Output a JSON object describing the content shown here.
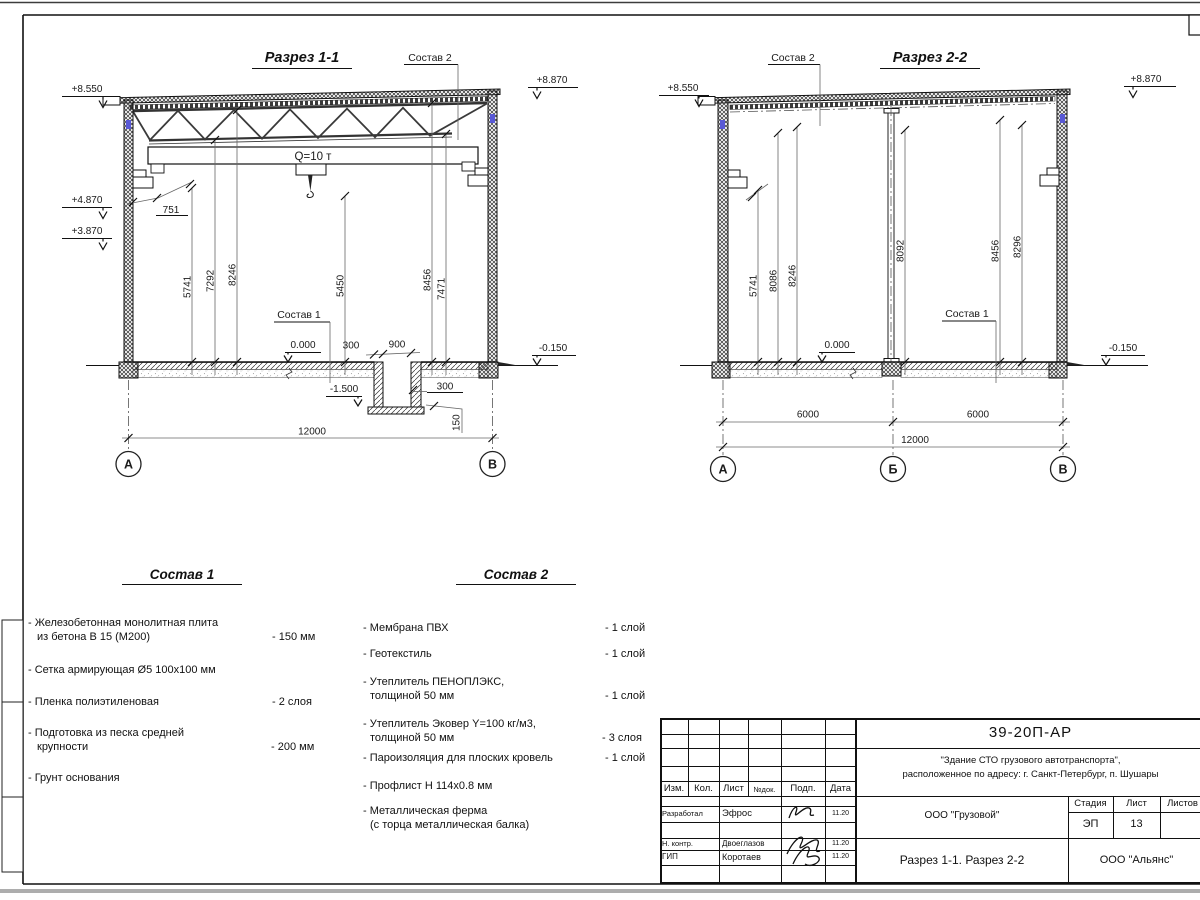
{
  "s1": {
    "title": "Разрез 1-1",
    "crane": "Q=10 т",
    "leader_roof": "Состав 2",
    "leader_floor": "Состав 1",
    "elev": {
      "top_left": "+8.550",
      "top_right": "+8.870",
      "bracket": "+4.870",
      "rail": "+3.870",
      "zero": "0.000",
      "grade": "-0.150",
      "pit": "-1.500"
    },
    "dim_751": "751",
    "vdims": [
      "5741",
      "7292",
      "8246",
      "5450",
      "8456",
      "7471"
    ],
    "pit": {
      "wall_left": "300",
      "width": "900",
      "wall_right": "300",
      "slab": "150"
    },
    "span_total": "12000",
    "axes": [
      "А",
      "В"
    ]
  },
  "s2": {
    "title": "Разрез 2-2",
    "leader_roof": "Состав 2",
    "leader_floor": "Состав 1",
    "elev": {
      "top_left": "+8.550",
      "top_right": "+8.870",
      "zero": "0.000",
      "grade": "-0.150"
    },
    "vdims": [
      "5741",
      "8086",
      "8246",
      "8092",
      "8456",
      "8296"
    ],
    "spans": [
      "6000",
      "6000"
    ],
    "span_total": "12000",
    "axes": [
      "А",
      "Б",
      "В"
    ]
  },
  "comp1": {
    "title": "Состав 1",
    "items": [
      {
        "l1": "- Железобетонная  монолитная плита",
        "l2": "из бетона В 15 (М200)",
        "val": "- 150 мм"
      },
      {
        "l1": "- Сетка армирующая Ø5 100х100 мм",
        "l2": "",
        "val": ""
      },
      {
        "l1": "- Пленка полиэтиленовая",
        "l2": "",
        "val": "-  2 слоя"
      },
      {
        "l1": "- Подготовка из песка средней",
        "l2": "крупности",
        "val": "- 200 мм"
      },
      {
        "l1": "- Грунт основания",
        "l2": "",
        "val": ""
      }
    ]
  },
  "comp2": {
    "title": "Состав 2",
    "items": [
      {
        "l1": "- Мембрана ПВХ",
        "l2": "",
        "val": "- 1 слой"
      },
      {
        "l1": "- Геотекстиль",
        "l2": "",
        "val": "- 1 слой"
      },
      {
        "l1": "- Утеплитель ПЕНОПЛЭКС,",
        "l2": "толщиной 50 мм",
        "val": "- 1 слой"
      },
      {
        "l1": "- Утеплитель Эковер Y=100 кг/м3,",
        "l2": "толщиной 50 мм",
        "val": "- 3 слоя"
      },
      {
        "l1": "- Пароизоляция для плоских кровель",
        "l2": "",
        "val": "- 1 слой"
      },
      {
        "l1": "- Профлист Н 114х0.8 мм",
        "l2": "",
        "val": ""
      },
      {
        "l1": "- Металлическая ферма",
        "l2": "(с торца металлическая балка)",
        "val": ""
      }
    ]
  },
  "tb": {
    "doc_number": "39-20П-АР",
    "project_line1": "\"Здание СТО грузового автотранспорта\",",
    "project_line2": "расположенное по адресу: г. Санкт-Петербург, п. Шушары",
    "client": "ООО \"Грузовой\"",
    "sheet_title": "Разрез 1-1. Разрез 2-2",
    "company": "ООО \"Альянс\"",
    "stage_label": "Стадия",
    "sheet_label": "Лист",
    "sheets_label": "Листов",
    "stage": "ЭП",
    "sheet_no": "13",
    "cols": {
      "izm": "Изм.",
      "kol": "Кол.",
      "list": "Лист",
      "ndoc": "№док.",
      "podp": "Подп.",
      "data": "Дата"
    },
    "rows": [
      {
        "role": "Разработал",
        "name": "Эфрос",
        "date": "11.20"
      },
      {
        "role": "Н. контр.",
        "name": "Двоеглазов",
        "date": "11.20"
      },
      {
        "role": "ГИП",
        "name": "Коротаев",
        "date": "11.20"
      }
    ]
  },
  "colors": {
    "embed_blue": "#5959d6",
    "line": "#111111"
  }
}
